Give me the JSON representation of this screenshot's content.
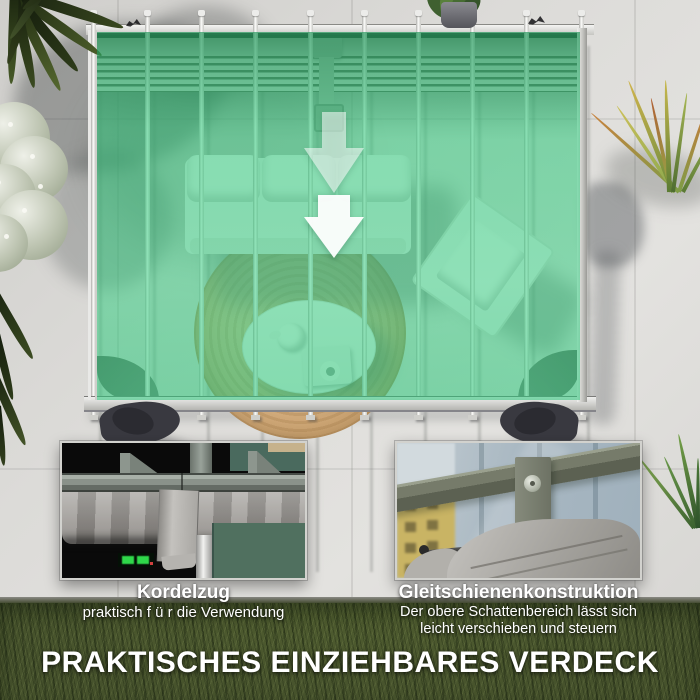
{
  "hero": {
    "arrow_icon": "double-down-arrow-icon",
    "canopy_overlay_color": "#2cc87a"
  },
  "features": [
    {
      "title": "Kordelzug",
      "description": "praktisch f ü r die Verwendung"
    },
    {
      "title": "Gleitschienenkonstruktion",
      "description_line1": "Der obere Schattenbereich lässt sich",
      "description_line2": "leicht verschieben und steuern"
    }
  ],
  "headline": "PRAKTISCHES EINZIEHBARES VERDECK",
  "colors": {
    "canopy_green": "#2cc87a",
    "concrete_gray": "#d6d5d3",
    "grass_green": "#46522c",
    "text": "#ffffff"
  }
}
